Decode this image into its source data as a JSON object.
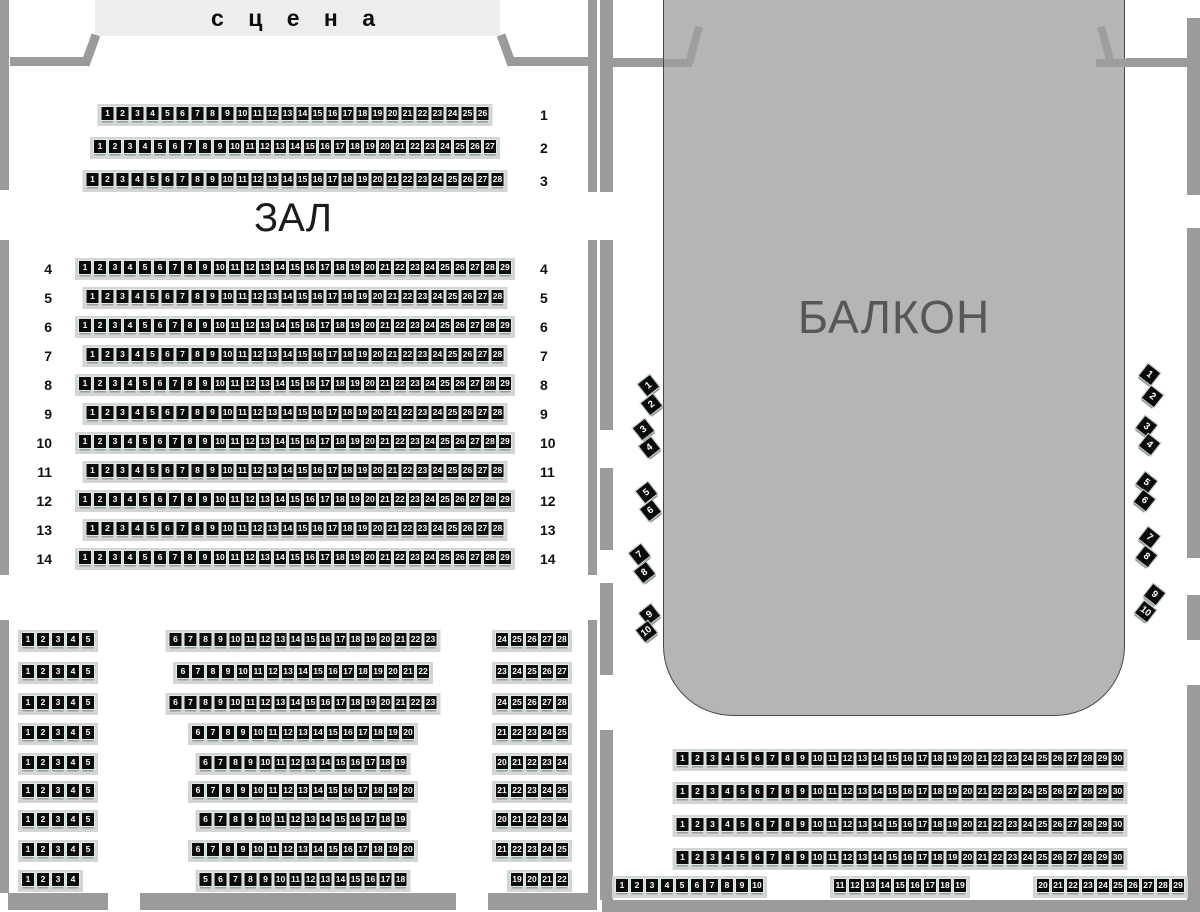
{
  "stage": {
    "label": "с ц е н а"
  },
  "hall": {
    "title": "ЗАЛ",
    "front_rows": [
      {
        "row": "1",
        "from": 1,
        "to": 26
      },
      {
        "row": "2",
        "from": 1,
        "to": 27
      },
      {
        "row": "3",
        "from": 1,
        "to": 28
      }
    ],
    "main_rows": [
      {
        "row": "4",
        "from": 1,
        "to": 29
      },
      {
        "row": "5",
        "from": 1,
        "to": 28
      },
      {
        "row": "6",
        "from": 1,
        "to": 29
      },
      {
        "row": "7",
        "from": 1,
        "to": 28
      },
      {
        "row": "8",
        "from": 1,
        "to": 29
      },
      {
        "row": "9",
        "from": 1,
        "to": 28
      },
      {
        "row": "10",
        "from": 1,
        "to": 29
      },
      {
        "row": "11",
        "from": 1,
        "to": 28
      },
      {
        "row": "12",
        "from": 1,
        "to": 29
      },
      {
        "row": "13",
        "from": 1,
        "to": 28
      },
      {
        "row": "14",
        "from": 1,
        "to": 29
      }
    ],
    "rear_rows": [
      {
        "blocks": [
          {
            "from": 1,
            "to": 5
          },
          {
            "from": 6,
            "to": 23
          },
          {
            "from": 24,
            "to": 28
          }
        ]
      },
      {
        "blocks": [
          {
            "from": 1,
            "to": 5
          },
          {
            "from": 6,
            "to": 22
          },
          {
            "from": 23,
            "to": 27
          }
        ]
      },
      {
        "blocks": [
          {
            "from": 1,
            "to": 5
          },
          {
            "from": 6,
            "to": 23
          },
          {
            "from": 24,
            "to": 28
          }
        ]
      },
      {
        "blocks": [
          {
            "from": 1,
            "to": 5
          },
          {
            "from": 6,
            "to": 20
          },
          {
            "from": 21,
            "to": 25
          }
        ]
      },
      {
        "blocks": [
          {
            "from": 1,
            "to": 5
          },
          {
            "from": 6,
            "to": 19
          },
          {
            "from": 20,
            "to": 24
          }
        ]
      },
      {
        "blocks": [
          {
            "from": 1,
            "to": 5
          },
          {
            "from": 6,
            "to": 20
          },
          {
            "from": 21,
            "to": 25
          }
        ]
      },
      {
        "blocks": [
          {
            "from": 1,
            "to": 5
          },
          {
            "from": 6,
            "to": 19
          },
          {
            "from": 20,
            "to": 24
          }
        ]
      },
      {
        "blocks": [
          {
            "from": 1,
            "to": 5
          },
          {
            "from": 6,
            "to": 20
          },
          {
            "from": 21,
            "to": 25
          }
        ]
      },
      {
        "blocks": [
          {
            "from": 1,
            "to": 4
          },
          {
            "from": 5,
            "to": 18
          },
          {
            "from": 19,
            "to": 22
          }
        ]
      }
    ]
  },
  "balcony": {
    "title": "БАЛКОН",
    "left_side_seats": [
      1,
      2,
      3,
      4,
      5,
      6,
      7,
      8,
      9,
      10
    ],
    "right_side_seats": [
      1,
      2,
      3,
      4,
      5,
      6,
      7,
      8,
      9,
      10
    ],
    "rows": [
      {
        "from": 1,
        "to": 30
      },
      {
        "from": 1,
        "to": 30
      },
      {
        "from": 1,
        "to": 30
      },
      {
        "from": 1,
        "to": 30
      }
    ],
    "last_row_blocks": [
      {
        "from": 1,
        "to": 10
      },
      {
        "from": 11,
        "to": 19
      },
      {
        "from": 20,
        "to": 29
      }
    ]
  },
  "colors": {
    "seat": "#0a0a0a",
    "wall": "#9b9b9b",
    "balcony_fill": "#b5b5b5",
    "stage_fill": "#ededed"
  }
}
